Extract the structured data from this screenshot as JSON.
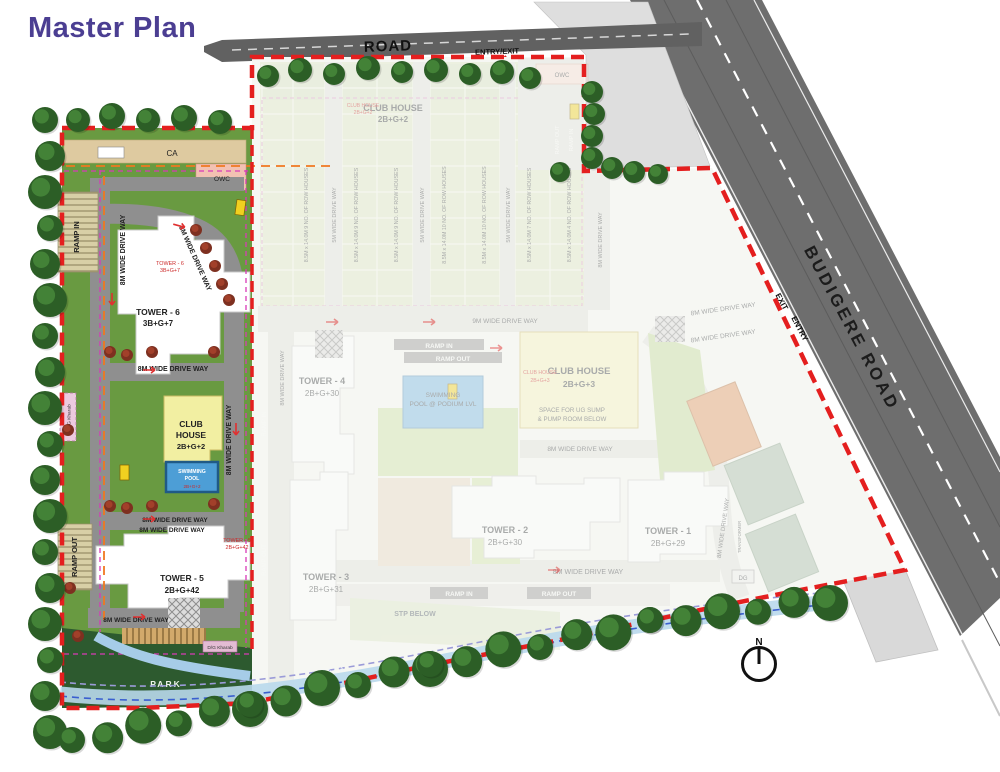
{
  "page": {
    "title": "Master Plan"
  },
  "colors": {
    "accent_purple": "#4b3e92",
    "boundary_red": "#e41f1f",
    "grass_green": "#699a41",
    "park_green": "#2d5a2f",
    "road_grey": "#6e6e6e",
    "clubhouse_yellow": "#f2efa2",
    "pool_blue": "#4d9ed6",
    "ca_tan": "#decaa0",
    "owc_pink": "#f2c1b2"
  },
  "roads": {
    "top_road": "ROAD",
    "entry_exit": "ENTRY/EXIT",
    "budigere_road": "BUDIGERE ROAD",
    "exit": "EXIT",
    "entry": "ENTRY"
  },
  "compass": {
    "north": "N"
  },
  "lp": {
    "ca": "CA",
    "owc": "OWC",
    "ramp_in": "RAMP IN",
    "ramp_out": "RAMP OUT",
    "drive_8m": "8M WIDE DRIVE WAY",
    "t6n": "TOWER - 6",
    "t6c": "3B+G+7",
    "t5n": "TOWER - 5",
    "t5c": "2B+G+42",
    "club1": "CLUB",
    "club2": "HOUSE",
    "clubc": "2B+G+2",
    "pool1": "SWIMMING",
    "pool2": "POOL",
    "park": "PARK",
    "nala": "NALA",
    "dg_kharab": "D/G Kharab"
  },
  "p2": {
    "clubA_n": "CLUB HOUSE",
    "clubA_c": "2B+G+2",
    "clubB_n": "CLUB HOUSE",
    "clubB_c": "2B+G+3",
    "sump1": "SPACE FOR UG SUMP",
    "sump2": "& PUMP ROOM BELOW",
    "t4n": "TOWER - 4",
    "t4c": "2B+G+30",
    "t3n": "TOWER - 3",
    "t3c": "2B+G+31",
    "t2n": "TOWER - 2",
    "t2c": "2B+G+30",
    "t1n": "TOWER - 1",
    "t1c": "2B+G+29",
    "row9": "8.5M x 14.0M 9 NO. OF ROW HOUSES",
    "row10": "8.5M x 14.0M 10 NO. OF ROW HOUSES",
    "row7": "8.5M x 14.0M 7 NO. OF ROW HOUSES",
    "row4": "8.5M x 14.0M 4 NO. OF ROW HOUSES",
    "d5": "5M WIDE DRIVE WAY",
    "d8": "8M WIDE DRIVE WAY",
    "d9": "9M WIDE DRIVE WAY",
    "pod1": "SWIMMING",
    "pod2": "POOL @ PODIUM LVL",
    "ramp_in": "RAMP IN",
    "ramp_out": "RAMP OUT",
    "stp": "STP BELOW",
    "dg": "DG",
    "owc": "OWC",
    "transformer": "TRANSFORMER"
  }
}
